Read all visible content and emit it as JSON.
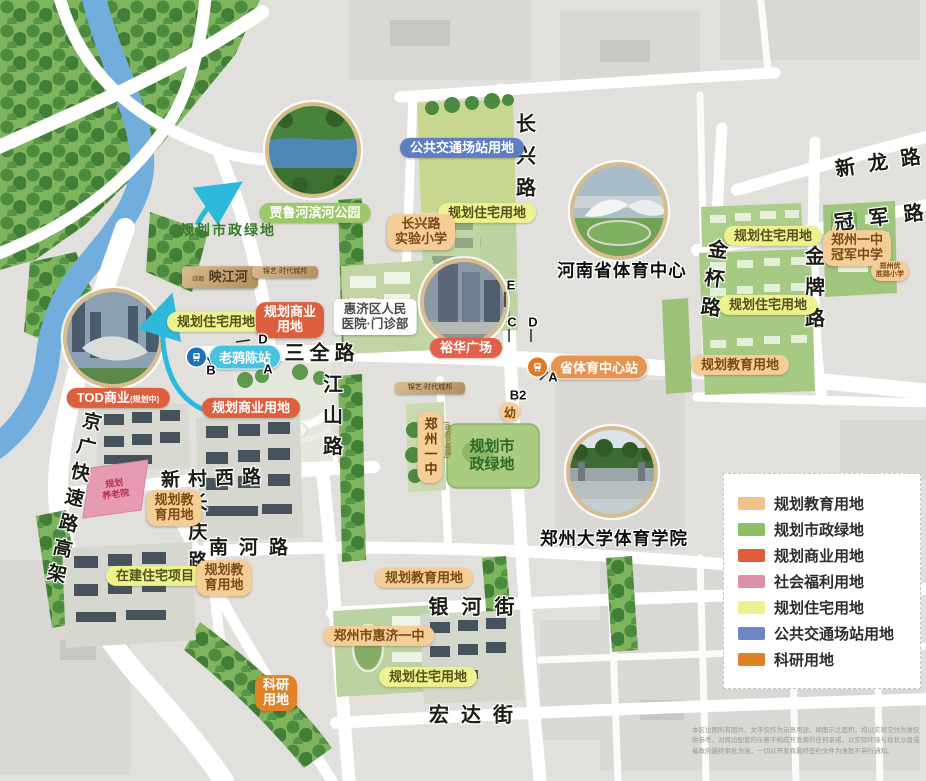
{
  "terms": {
    "res": "规划住宅用地",
    "edu": "规划教育用地",
    "edu_l1": "规划教",
    "edu_l2": "育用地",
    "com": "规划商业用地",
    "com_l1": "规划商业",
    "com_l2": "用地",
    "green": "规划市政绿地",
    "green_l1": "规划市",
    "green_l2": "政绿地",
    "bus": "公共交通场站用地",
    "constr": "在建住宅项目",
    "sci_l1": "科研",
    "sci_l2": "用地",
    "wel_l1": "规划",
    "wel_l2": "养老院",
    "tod": "TOD商业",
    "tod_note": "(规划中)"
  },
  "roads": {
    "changxing": "长兴路",
    "xinlong": "新龙路",
    "guanjun": "冠军路",
    "jinbei": "金杯路",
    "jinpai": "金牌路",
    "sanquan": "三全路",
    "jiangshan": "江山路",
    "xincunxi": "新村西路",
    "changqing": "长庆路",
    "nanhe": "南河路",
    "yinhe": "银河街",
    "hongda": "宏达街",
    "jingguang": "京广快速路高架"
  },
  "stations": {
    "laoyachen": "老鸦陈站",
    "sports_center": "省体育中心站"
  },
  "landmarks": {
    "riverside_park": "贾鲁河滨河公园",
    "henan_sports_center": "河南省体育中心",
    "zzu_sports_college": "郑州大学体育学院",
    "hospital_l1": "惠济区人民",
    "hospital_l2": "医院·门诊部",
    "yuhua_plaza": "裕华广场",
    "cx_school_l1": "长兴路",
    "cx_school_l2": "实验小学",
    "gj_school_l1": "郑州一中",
    "gj_school_l2": "冠军中学",
    "ys_school_l1": "郑州优",
    "ys_school_l2": "胜路小学",
    "no1_middle": "郑州一中",
    "no1_middle_note": "(政府已挂牌)",
    "huiji_no1": "郑州市惠济一中",
    "kindergarten": "幼"
  },
  "plaques": {
    "brand_small": "绿都",
    "yingjianghe": "映江河",
    "estate_a": "锦艺·时代城邦",
    "estate_b": "锦艺·时代城邦"
  },
  "exits": {
    "a": "A",
    "b": "B",
    "b2": "B2",
    "c": "C",
    "d": "D",
    "e": "E"
  },
  "legend": {
    "items": [
      {
        "label": "规划教育用地",
        "color": "#F2C28E"
      },
      {
        "label": "规划市政绿地",
        "color": "#8CC063"
      },
      {
        "label": "规划商业用地",
        "color": "#DE5B3B"
      },
      {
        "label": "社会福利用地",
        "color": "#DF8FA9"
      },
      {
        "label": "规划住宅用地",
        "color": "#EDF28C"
      },
      {
        "label": "公共交通场站用地",
        "color": "#6B87C5"
      },
      {
        "label": "科研用地",
        "color": "#DF8124"
      }
    ]
  },
  "disclaimer": "本区位图所有图片、文字仅作为示意用途，除图示之面积，均以实际交付为准仅供参考，对周边配套的示意不构成开发商的任何承诺，以实际环境与现状沙盘或者政府最终审批为准，一切以开发商最终签约文件为准恕不另行通知。"
}
